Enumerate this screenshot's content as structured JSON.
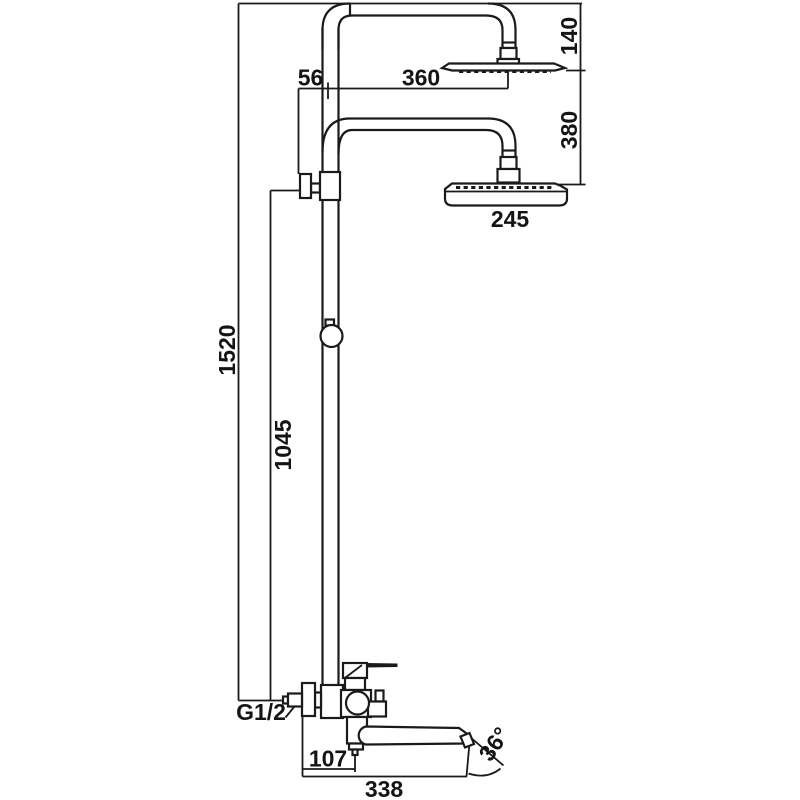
{
  "meta": {
    "drawing_kind": "shower-column-mixer-dimension-drawing",
    "background_color": "#ffffff",
    "line_color": "#1a1a1a",
    "text_color": "#141414"
  },
  "labels": {
    "overall_height": "1520",
    "outlet_to_mixer_height": "1045",
    "wall_to_riser": "56",
    "riser_to_top_head": "360",
    "top_head_drop": "140",
    "heads_vertical_gap": "380",
    "bottom_head_width": "245",
    "mixer_to_spout_drop": "107",
    "spout_reach": "338",
    "spray_angle": "36°",
    "inlet_thread": "G1/2"
  }
}
